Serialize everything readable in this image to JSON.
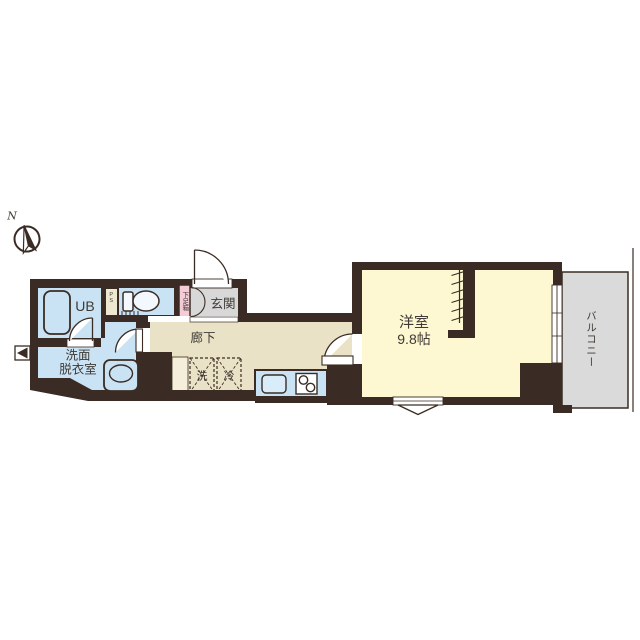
{
  "title": "apartment-floor-plan",
  "compass": {
    "north_label": "N"
  },
  "rooms": {
    "unit_bath": {
      "label": "UB"
    },
    "pipe_space": {
      "label": "PS"
    },
    "toilet": {
      "label": ""
    },
    "shoe_box": {
      "label": "下足箱"
    },
    "entrance": {
      "label": "玄関"
    },
    "corridor": {
      "label": "廊下"
    },
    "washroom": {
      "label_line1": "洗面",
      "label_line2": "脱衣室"
    },
    "washer_spot": {
      "label": "洗"
    },
    "fridge_spot": {
      "label": "冷"
    },
    "western_room": {
      "label": "洋室",
      "size": "9.8帖"
    },
    "balcony": {
      "label": "バルコニー"
    }
  },
  "icons": [
    "compass-icon",
    "bathtub-icon",
    "toilet-icon",
    "wash-basin-icon",
    "kitchen-sink-icon",
    "stove-icon",
    "hanger-pipe-icon",
    "door-swing-icon",
    "double-door-icon",
    "window-icon",
    "vent-icon",
    "bay-window-icon"
  ],
  "colors": {
    "wall": "#3a2c24",
    "water_rooms_blue": "#c9e3f4",
    "corridor_beige": "#eae2c6",
    "main_room_yellow": "#fdf8d1",
    "entrance_gray": "#d8d8d8",
    "balcony_gray": "#dadada",
    "shoe_box_pink": "#f4cbd6",
    "pillar_cream": "#f5eedb",
    "fixture_white": "#ffffff",
    "text": "#3f3a35"
  }
}
